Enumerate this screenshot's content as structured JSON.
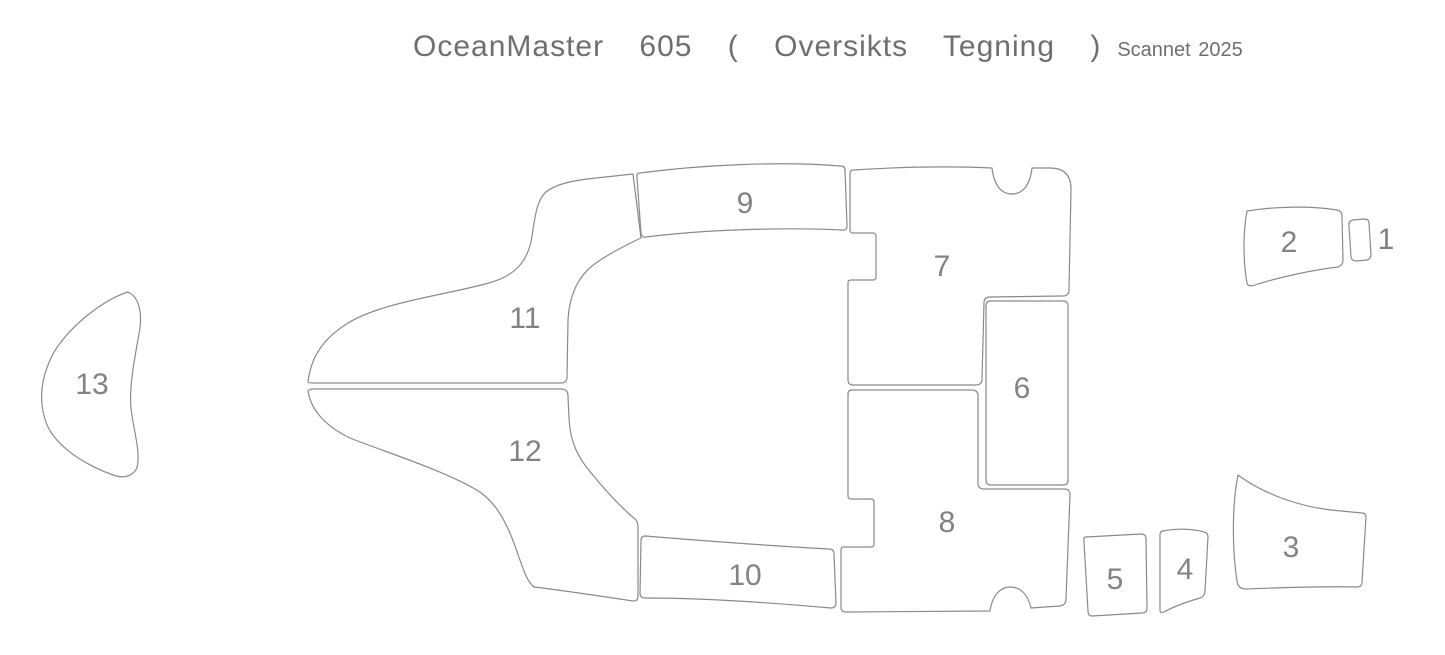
{
  "title": {
    "main": "OceanMaster 605 ( Oversikts Tegning )",
    "note": "Scannet 2025"
  },
  "colors": {
    "background": "#ffffff",
    "line": "#8a8a8a",
    "label": "#828282",
    "title": "#6f6f6f"
  },
  "drawing": {
    "type": "boat-deck-panel-overview",
    "panel_count": 13
  },
  "panels": [
    {
      "id": 1,
      "label": "1"
    },
    {
      "id": 2,
      "label": "2"
    },
    {
      "id": 3,
      "label": "3"
    },
    {
      "id": 4,
      "label": "4"
    },
    {
      "id": 5,
      "label": "5"
    },
    {
      "id": 6,
      "label": "6"
    },
    {
      "id": 7,
      "label": "7"
    },
    {
      "id": 8,
      "label": "8"
    },
    {
      "id": 9,
      "label": "9"
    },
    {
      "id": 10,
      "label": "10"
    },
    {
      "id": 11,
      "label": "11"
    },
    {
      "id": 12,
      "label": "12"
    },
    {
      "id": 13,
      "label": "13"
    }
  ]
}
